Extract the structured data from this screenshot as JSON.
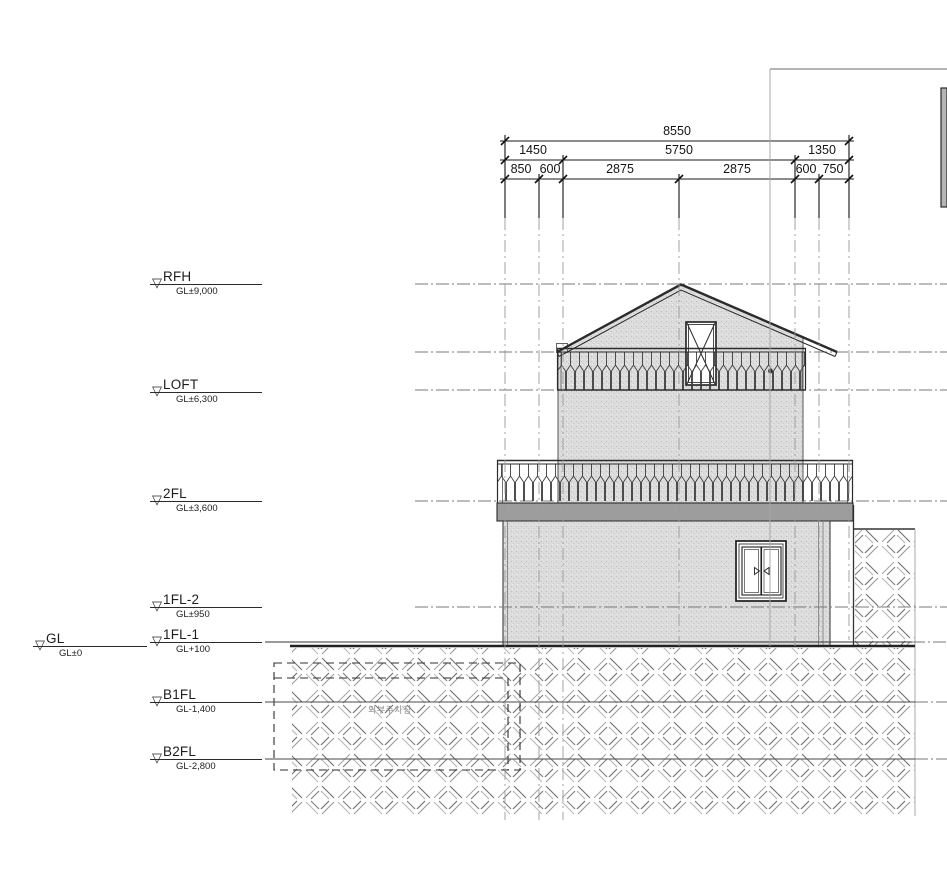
{
  "drawing_type": "section-elevation",
  "levels": [
    {
      "name": "RFH",
      "elev": "GL±9,000"
    },
    {
      "name": "LOFT",
      "elev": "GL±6,300"
    },
    {
      "name": "2FL",
      "elev": "GL±3,600"
    },
    {
      "name": "1FL-2",
      "elev": "GL±950"
    },
    {
      "name": "1FL-1",
      "elev": "GL+100"
    },
    {
      "name": "GL",
      "elev": "GL±0"
    },
    {
      "name": "B1FL",
      "elev": "GL-1,400"
    },
    {
      "name": "B2FL",
      "elev": "GL-2,800"
    }
  ],
  "dimensions": {
    "total": "8550",
    "row2": [
      "1450",
      "5750",
      "1350"
    ],
    "row3": [
      "850",
      "600",
      "2875",
      "2875",
      "600",
      "750"
    ]
  },
  "labels": {
    "parking": "외부주차장"
  },
  "colors": {
    "wall_fill": "#dcdcdc",
    "slab_fill": "#9d9d9d",
    "line_dark": "#2b2b2b",
    "line_mid": "#777777",
    "hatch_light": "#b0b0b0",
    "hatch_dark": "#6e6e6e"
  }
}
